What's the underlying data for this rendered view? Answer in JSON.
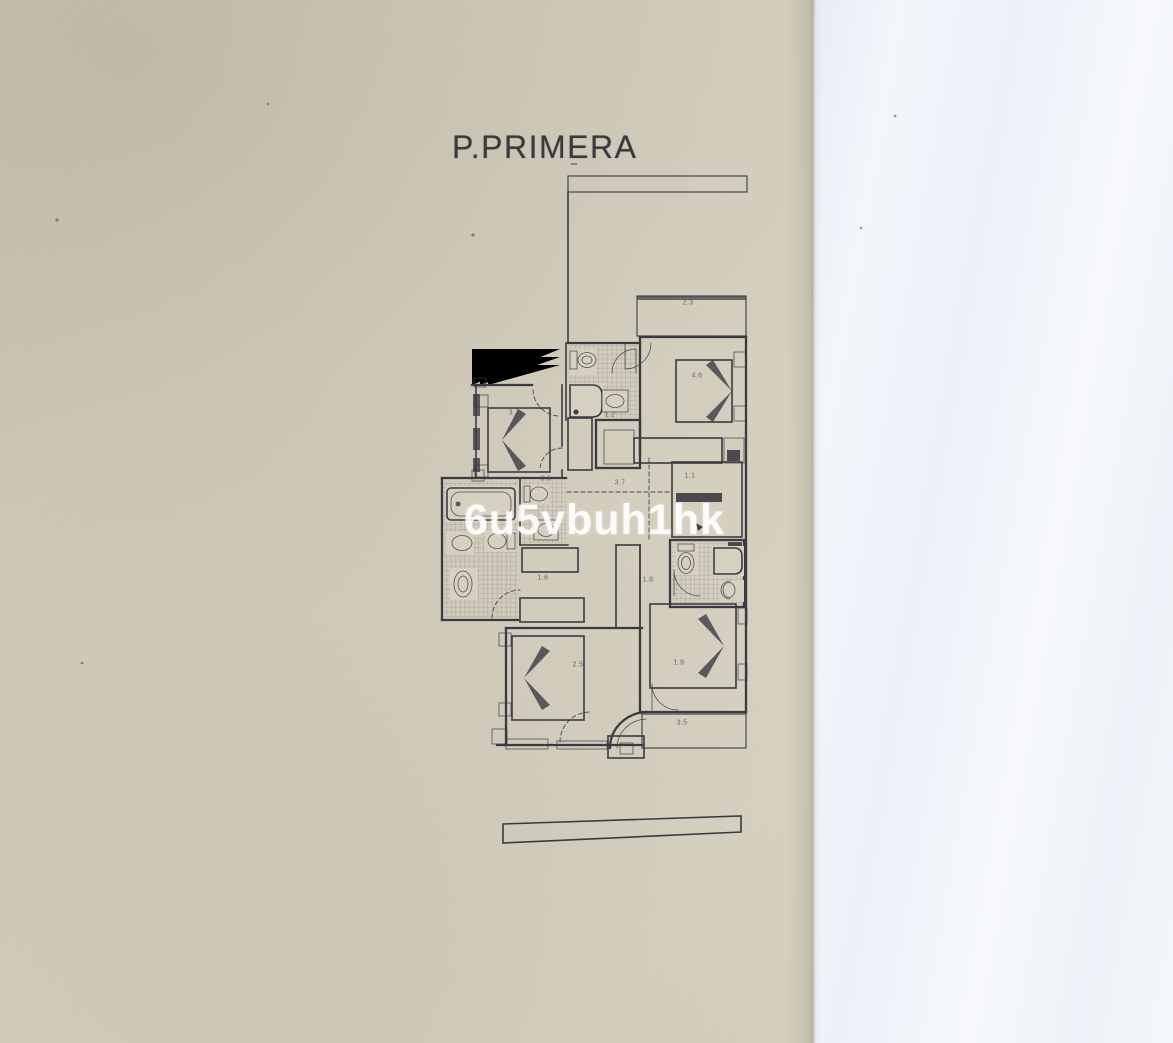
{
  "document": {
    "title": "P.PRIMERA",
    "watermark": "6u5vbuh1hk"
  },
  "colors": {
    "paper_beige": "#d2ccbc",
    "paper_white": "#f3f6fb",
    "ink": "#3c3a41",
    "title": "#3b393c",
    "watermark": "rgba(255,255,255,0.87)"
  },
  "plan": {
    "floor_label": "P.PRIMERA",
    "dimension_labels": [
      {
        "text": "2.3",
        "x": 688,
        "y": 303
      },
      {
        "text": "3.7",
        "x": 514,
        "y": 413
      },
      {
        "text": "4.6",
        "x": 697,
        "y": 376
      },
      {
        "text": "1.2",
        "x": 610,
        "y": 415
      },
      {
        "text": "0.5",
        "x": 546,
        "y": 479
      },
      {
        "text": "3.7",
        "x": 620,
        "y": 483
      },
      {
        "text": "1.1",
        "x": 690,
        "y": 476
      },
      {
        "text": "1.6",
        "x": 543,
        "y": 578
      },
      {
        "text": "1.8",
        "x": 648,
        "y": 580
      },
      {
        "text": "2.5",
        "x": 578,
        "y": 665
      },
      {
        "text": "1.9",
        "x": 679,
        "y": 663
      },
      {
        "text": "3.5",
        "x": 682,
        "y": 723
      }
    ]
  }
}
